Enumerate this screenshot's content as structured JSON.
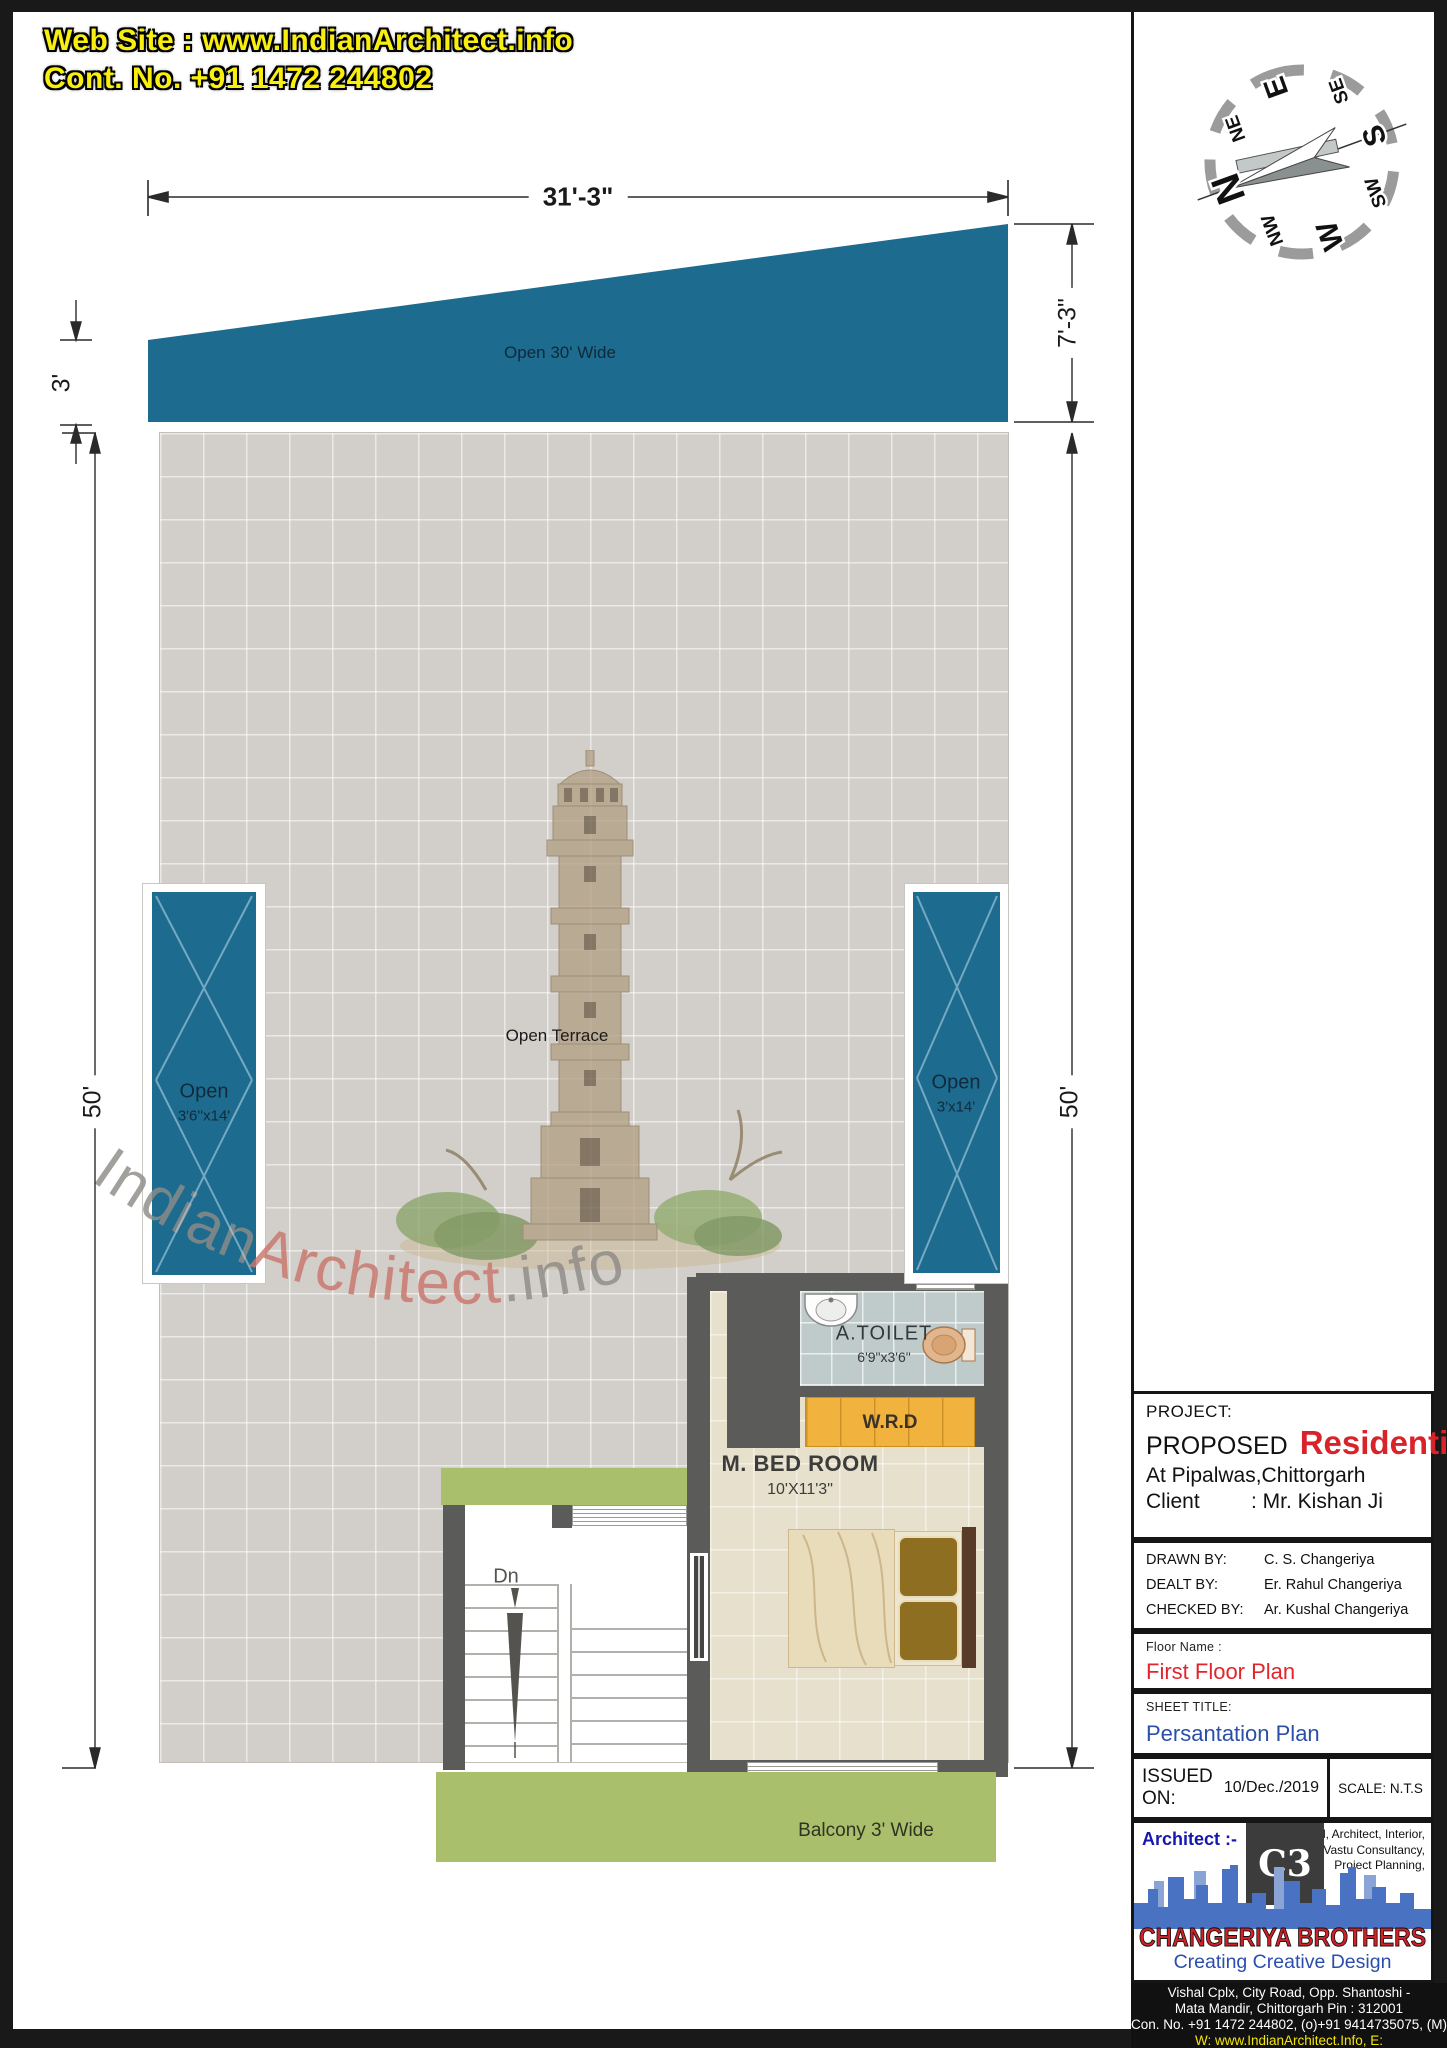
{
  "header": {
    "website": "Web Site : www.IndianArchitect.info",
    "contact": "Cont. No. +91 1472 244802"
  },
  "compass": {
    "directions": [
      "N",
      "NE",
      "E",
      "SE",
      "S",
      "SW",
      "W",
      "NW"
    ]
  },
  "dimensions": {
    "top_width": "31'-3\"",
    "left_small": "3'",
    "right_small": "7'-3\"",
    "left_height": "50'",
    "right_height": "50'"
  },
  "plan": {
    "open_top": "Open  30' Wide",
    "open_left_line1": "Open",
    "open_left_line2": "3'6''x14'",
    "open_right_line1": "Open",
    "open_right_line2": "3'x14'",
    "terrace": "Open Terrace",
    "toilet_name": "A.TOILET",
    "toilet_size": "6'9\"x3'6\"",
    "wardrobe": "W.R.D",
    "bedroom_name": "M. BED ROOM",
    "bedroom_size": "10'X11'3\"",
    "stairs_down": "Dn",
    "balcony": "Balcony 3' Wide"
  },
  "watermark": {
    "part1": "Indian",
    "part2": "Architect",
    "part3": ".info"
  },
  "titleblock": {
    "project_label": "PROJECT:",
    "proposed": "PROPOSED",
    "type": "Residential",
    "location": "At  Pipalwas,Chittorgarh",
    "client_label": "Client",
    "client_value": ": Mr. Kishan Ji",
    "drawn_label": "DRAWN BY:",
    "drawn_value": "C. S. Changeriya",
    "dealt_label": "DEALT BY:",
    "dealt_value": "Er. Rahul Changeriya",
    "checked_label": "CHECKED BY:",
    "checked_value": "Ar. Kushal Changeriya",
    "floor_label": "Floor Name :",
    "floor_value": "First Floor Plan",
    "sheet_label": "SHEET TITLE:",
    "sheet_value": "Persantation Plan",
    "issued_label": "ISSUED ON:",
    "issued_value": "10/Dec./2019",
    "scale": "SCALE: N.T.S",
    "architect_label": "Architect :-",
    "services": [
      "Civil, Architect, Interior,",
      "Vastu Consultancy,",
      "Project Planning,"
    ],
    "logo_mark": "C3",
    "company": "CHANGERIYA BROTHERS",
    "tagline": "Creating Creative Design",
    "address1": "Vishal Cplx, City Road, Opp. Shantoshi -",
    "address2": "Mata Mandir, Chittorgarh Pin : 312001",
    "contact_line": "Con. No. +91 1472 244802, (o)+91 9414735075, (M)",
    "web_line": "W: www.IndianArchitect.Info, E: info@IndianArchitect.Info"
  },
  "colors": {
    "open_blue": "#1d6b8e",
    "wall_gray": "#5b5b59",
    "terrace_gray": "#d2cfca",
    "bedroom_beige": "#e7e0cd",
    "toilet_gray": "#bfcaca",
    "wardrobe_orange": "#f1b23e",
    "balcony_green": "#a9bf6c",
    "accent_red": "#d8232a",
    "accent_blue": "#2b4ea8",
    "header_yellow": "#f8ee10"
  }
}
